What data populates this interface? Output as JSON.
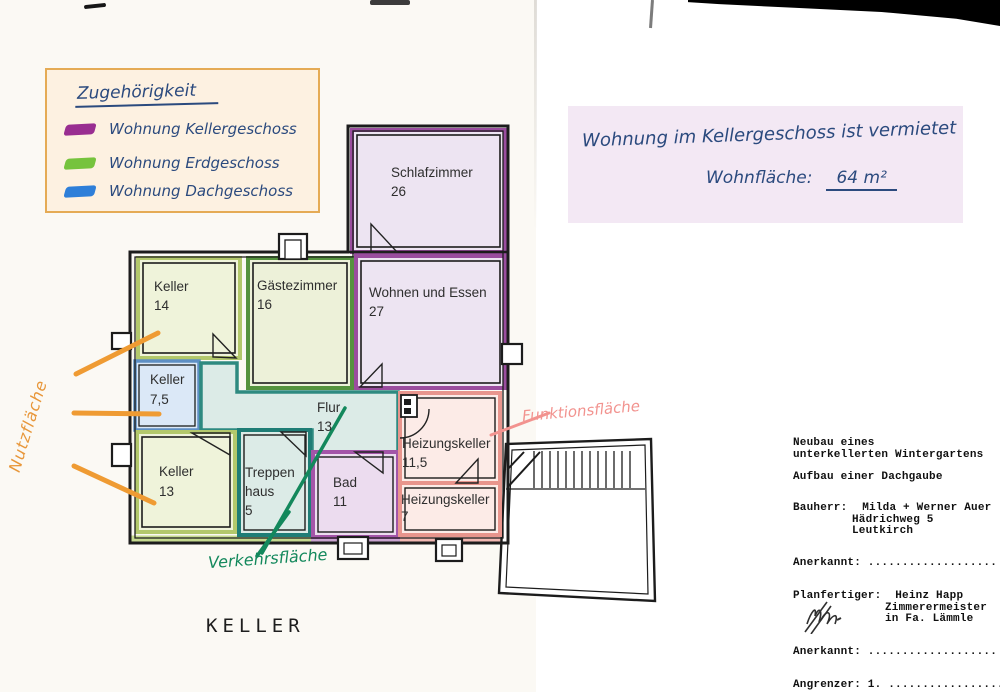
{
  "legend": {
    "title": "Zugehörigkeit",
    "items": [
      {
        "label": "Wohnung Kellergeschoss",
        "color": "#992e91"
      },
      {
        "label": "Wohnung Erdgeschoss",
        "color": "#76c33d"
      },
      {
        "label": "Wohnung Dachgeschoss",
        "color": "#2e7fd9"
      }
    ]
  },
  "note": {
    "line1": "Wohnung im Kellergeschoss ist vermietet",
    "label": "Wohnfläche:",
    "value": "64 m²"
  },
  "plan": {
    "floor_label": "KELLER",
    "rooms": [
      {
        "id": "schlafzimmer",
        "lines": [
          "Schlafzimmer",
          "26"
        ],
        "color": "#ede4f2"
      },
      {
        "id": "keller-14",
        "lines": [
          "Keller",
          "14"
        ],
        "color": "#eff3da"
      },
      {
        "id": "gaestezimmer",
        "lines": [
          "Gästezimmer",
          "16"
        ],
        "color": "#edf1d9"
      },
      {
        "id": "wohnen-und-essen",
        "lines": [
          "Wohnen und Essen",
          "27"
        ],
        "color": "#ede4f2"
      },
      {
        "id": "keller-7-5",
        "lines": [
          "Keller",
          "7,5"
        ],
        "color": "#dbe8f7"
      },
      {
        "id": "flur",
        "lines": [
          "Flur",
          "13"
        ],
        "color": "#dcebe7"
      },
      {
        "id": "keller-13",
        "lines": [
          "Keller",
          "13"
        ],
        "color": "#eff3da"
      },
      {
        "id": "treppenhaus",
        "lines": [
          "Treppen",
          "haus",
          "5"
        ],
        "color": "#dcebe7"
      },
      {
        "id": "bad",
        "lines": [
          "Bad",
          "11"
        ],
        "color": "#ecdcef"
      },
      {
        "id": "heizungskeller-11-5",
        "lines": [
          "Heizungskeller",
          "11,5"
        ],
        "color": "#fcebe7"
      },
      {
        "id": "heizungskeller-7",
        "lines": [
          "Heizungskeller",
          "7"
        ],
        "color": "#fcebe7"
      }
    ],
    "annotations": {
      "nutzflaeche": "Nutzfläche",
      "funktionsflaeche": "Funktionsfläche",
      "verkehrsflaeche": "Verkehrsfläche"
    },
    "annotation_colors": {
      "nutzflaeche": "#e8973a",
      "funktionsflaeche": "#f2938f",
      "verkehrsflaeche": "#13885c"
    }
  },
  "title_block": {
    "project_line1": "Neubau eines",
    "project_line2": "unterkellerten Wintergartens",
    "project_line3": "Aufbau einer Dachgaube",
    "bauherr_label": "Bauherr:",
    "bauherr_name": "Milda + Werner Auer",
    "bauherr_street": "Hädrichweg 5",
    "bauherr_city": "Leutkirch",
    "anerkannt_1": "Anerkannt: ...................",
    "planfertiger_label": "Planfertiger:",
    "planfertiger_name": "Heinz Happ",
    "planfertiger_role": "Zimmerermeister",
    "planfertiger_company": "in Fa. Lämmle",
    "anerkannt_2": "Anerkannt: ...................",
    "angrenzer": "Angrenzer: 1. .................."
  }
}
